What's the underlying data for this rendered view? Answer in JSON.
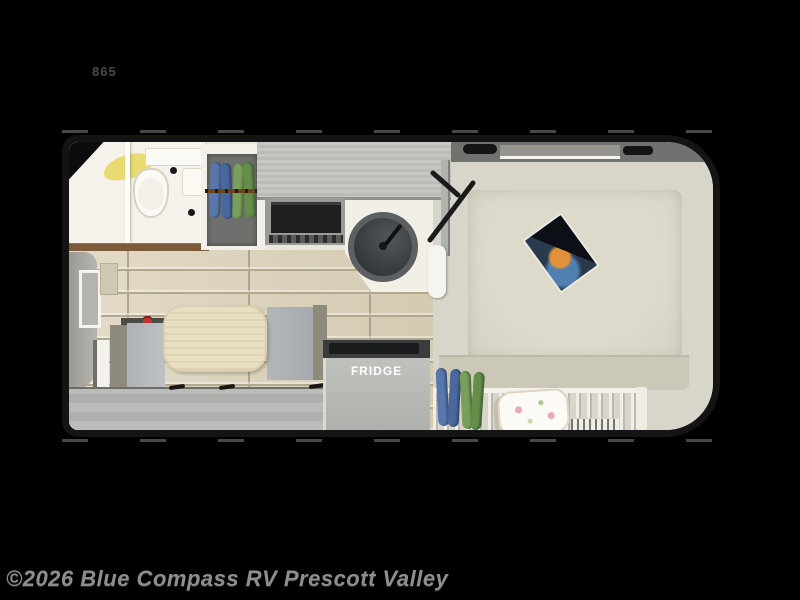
{
  "page": {
    "background_color": "#000000"
  },
  "floorplan": {
    "model_label": "865",
    "fridge_label": "FRIDGE",
    "type": "truck-camper floor plan illustration",
    "rooms": [
      "bathroom",
      "wardrobe",
      "kitchen",
      "dinette",
      "bedroom"
    ],
    "features": [
      "toilet",
      "shower-towel",
      "bathroom-sink",
      "hanging-clothes",
      "microwave-range",
      "round-kitchen-sink",
      "entry-door-swing",
      "dinette-table",
      "bench-seat",
      "fridge",
      "bed",
      "magazine",
      "pillow",
      "bed-rail-fence",
      "floor-vent",
      "front-window",
      "fire-extinguisher"
    ],
    "colors": {
      "outline": "#141414",
      "bathroom": "#f4f2ea",
      "cabinet_gray": "#c0c2be",
      "tile_floor": "#d9d0bb",
      "table": "#e8dfc3",
      "bed": "#dad6c8",
      "clothes_blue": "#5878ad",
      "clothes_green": "#79a05a",
      "towel_yellow": "#e9da72",
      "wood_ledge": "#7d5b38",
      "fridge_text": "#ffffff"
    }
  },
  "watermark": {
    "text": "©2026 Blue Compass RV Prescott Valley",
    "color": "#8e8e8e"
  }
}
